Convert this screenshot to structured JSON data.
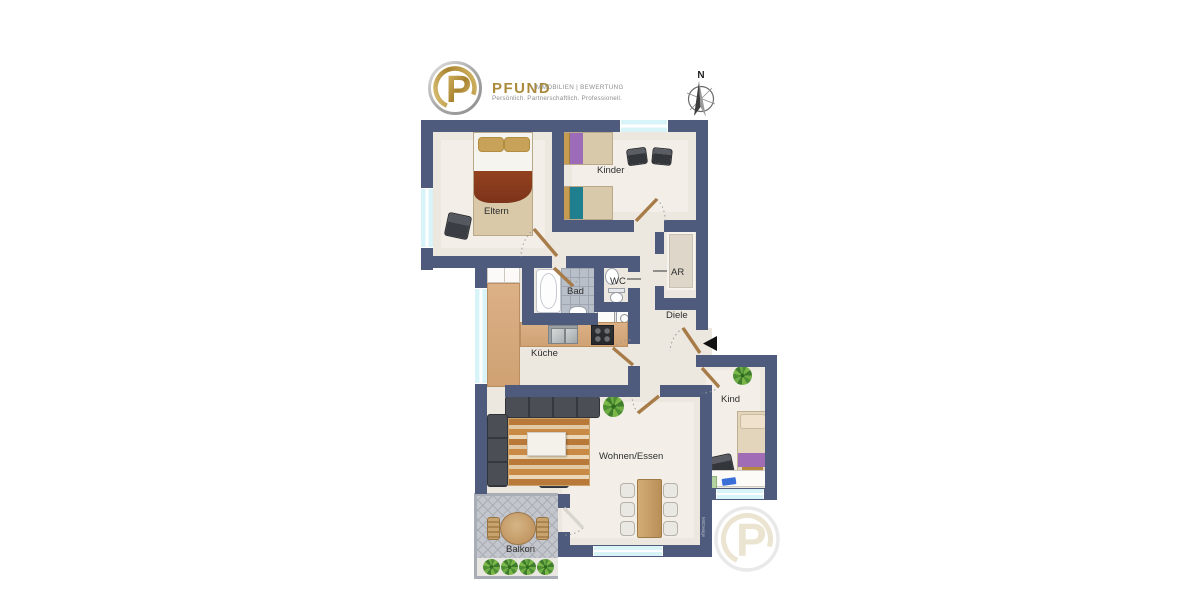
{
  "branding": {
    "logo_letter": "P",
    "company": "PFUND",
    "division": "IMMOBILIEN | BEWERTUNG",
    "tagline": "Persönlich. Partnerschaftlich. Professionell."
  },
  "compass": {
    "north": "N"
  },
  "rooms": {
    "eltern": "Eltern",
    "kinder": "Kinder",
    "bad": "Bad",
    "wc": "WC",
    "ar": "AR",
    "diele": "Diele",
    "kueche": "Küche",
    "wohnen_essen": "Wohnen/Essen",
    "kind": "Kind",
    "balkon": "Balkon"
  },
  "watermark": {
    "logo_letter": "P",
    "side_text": "MöDesign"
  },
  "colors": {
    "wall": "#4f5b7d",
    "floor": "#ece7df",
    "window_glass": "#d9f4f9",
    "door_leaf": "#a87c48",
    "logo_gold": "#ab8a3a",
    "balcony_floor": "#c3c6cc"
  }
}
